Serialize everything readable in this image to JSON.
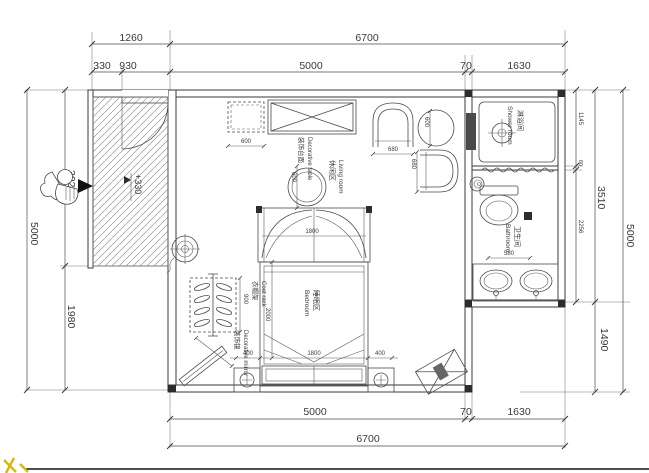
{
  "colors": {
    "line": "#3f3f3f",
    "dim_text": "#3a3a3a",
    "hatch": "#9a9a9a",
    "fill_dark": "#2c2c2c",
    "watermark_yellow": "#d9b60a"
  },
  "dimensions": {
    "top_row1": [
      "1260",
      "6700"
    ],
    "top_row2": [
      "330",
      "930",
      "5000",
      "70",
      "1630"
    ],
    "bottom_row1": [
      "5000",
      "70",
      "1630"
    ],
    "bottom_row2": [
      "6700"
    ],
    "left": {
      "total": "5000",
      "upper": "3020",
      "lower": "1980"
    },
    "right": {
      "inner": [
        "1145",
        "60",
        "2256"
      ],
      "mid": [
        "3510",
        "1490"
      ],
      "total": "5000"
    }
  },
  "rooms": {
    "living": {
      "zh": "休闲区",
      "en": "Living room"
    },
    "bedroom": {
      "zh": "睡眠区",
      "en": "Bedroom"
    },
    "bathroom": {
      "zh": "卫生间",
      "en": "Bathroom"
    },
    "shower": {
      "zh": "淋浴间",
      "en": "Shower room"
    }
  },
  "furniture": {
    "coat_rack": {
      "zh": "衣帽架",
      "en": "Coat rack",
      "width": "900"
    },
    "decorative_mirror": {
      "zh": "装饰镜",
      "en": "Decorative mirror"
    },
    "decorative_table": {
      "zh": "装饰台面",
      "en": "Decorative table",
      "diameter": "600"
    },
    "side_cabinet_width": "600",
    "tea_table_diameter": "600",
    "armchair_width": "680",
    "armchair_depth": "680",
    "canopy_width": "1800",
    "bed_width": "1800",
    "bed_length": "2000",
    "nightstand_left": "400",
    "nightstand_right": "400",
    "toilet_width": "580"
  },
  "annotations": {
    "entry_level": "+330"
  }
}
